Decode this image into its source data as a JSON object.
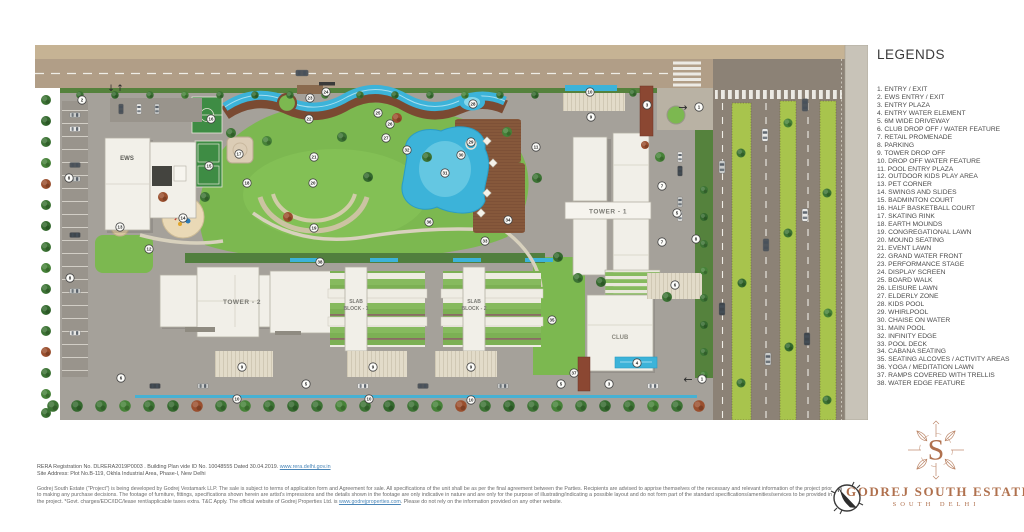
{
  "legend": {
    "title": "LEGENDS",
    "items": [
      "ENTRY / EXIT",
      "EWS ENTRY / EXIT",
      "ENTRY PLAZA",
      "ENTRY WATER ELEMENT",
      "6M WIDE DRIVEWAY",
      "CLUB DROP OFF / WATER FEATURE",
      "RETAIL PROMENADE",
      "PARKING",
      "TOWER DROP OFF",
      "DROP OFF WATER FEATURE",
      "POOL ENTRY PLAZA",
      "OUTDOOR KIDS PLAY AREA",
      "PET CORNER",
      "SWINGS AND SLIDES",
      "BADMINTON COURT",
      "HALF BASKETBALL COURT",
      "SKATING RINK",
      "EARTH MOUNDS",
      "CONGREGATIONAL LAWN",
      "MOUND SEATING",
      "EVENT LAWN",
      "GRAND WATER FRONT",
      "PERFORMANCE STAGE",
      "DISPLAY SCREEN",
      "BOARD WALK",
      "LEISURE LAWN",
      "ELDERLY ZONE",
      "KIDS POOL",
      "WHIRLPOOL",
      "CHAISE ON WATER",
      "MAIN POOL",
      "INFINITY EDGE",
      "POOL DECK",
      "CABANA SEATING",
      "SEATING ALCOVES / ACTIVITY AREAS",
      "YOGA / MEDITATION LAWN",
      "RAMPS COVERED WITH TRELLIS",
      "WATER EDGE FEATURE"
    ]
  },
  "plan": {
    "labels": {
      "ews": "EWS",
      "tower1": "TOWER - 1",
      "tower2": "TOWER - 2",
      "slab1_line1": "SLAB",
      "slab1_line2": "BLOCK - 1",
      "slab2_line1": "SLAB",
      "slab2_line2": "BLOCK - 2",
      "club": "CLUB"
    },
    "arrows": {
      "right": "→",
      "left": "←",
      "down": "↓",
      "up": "↑"
    },
    "markers": [
      {
        "n": 1,
        "x": 664,
        "y": 62
      },
      {
        "n": 1,
        "x": 667,
        "y": 334
      },
      {
        "n": 2,
        "x": 47,
        "y": 55
      },
      {
        "n": 3,
        "x": 612,
        "y": 60
      },
      {
        "n": 3,
        "x": 574,
        "y": 339
      },
      {
        "n": 4,
        "x": 602,
        "y": 318
      },
      {
        "n": 5,
        "x": 642,
        "y": 168
      },
      {
        "n": 5,
        "x": 271,
        "y": 339
      },
      {
        "n": 5,
        "x": 526,
        "y": 339
      },
      {
        "n": 6,
        "x": 86,
        "y": 333
      },
      {
        "n": 6,
        "x": 640,
        "y": 240
      },
      {
        "n": 7,
        "x": 627,
        "y": 141
      },
      {
        "n": 7,
        "x": 627,
        "y": 197
      },
      {
        "n": 8,
        "x": 34,
        "y": 133
      },
      {
        "n": 8,
        "x": 35,
        "y": 233
      },
      {
        "n": 8,
        "x": 661,
        "y": 194
      },
      {
        "n": 9,
        "x": 556,
        "y": 72
      },
      {
        "n": 9,
        "x": 207,
        "y": 322
      },
      {
        "n": 9,
        "x": 338,
        "y": 322
      },
      {
        "n": 9,
        "x": 436,
        "y": 322
      },
      {
        "n": 10,
        "x": 555,
        "y": 47
      },
      {
        "n": 10,
        "x": 202,
        "y": 354
      },
      {
        "n": 10,
        "x": 334,
        "y": 354
      },
      {
        "n": 10,
        "x": 436,
        "y": 355
      },
      {
        "n": 11,
        "x": 501,
        "y": 102
      },
      {
        "n": 12,
        "x": 114,
        "y": 204
      },
      {
        "n": 13,
        "x": 85,
        "y": 182
      },
      {
        "n": 14,
        "x": 148,
        "y": 173
      },
      {
        "n": 15,
        "x": 174,
        "y": 121
      },
      {
        "n": 16,
        "x": 176,
        "y": 74
      },
      {
        "n": 17,
        "x": 204,
        "y": 109
      },
      {
        "n": 18,
        "x": 212,
        "y": 138
      },
      {
        "n": 19,
        "x": 279,
        "y": 183
      },
      {
        "n": 20,
        "x": 278,
        "y": 138
      },
      {
        "n": 21,
        "x": 279,
        "y": 112
      },
      {
        "n": 22,
        "x": 274,
        "y": 74
      },
      {
        "n": 23,
        "x": 275,
        "y": 53
      },
      {
        "n": 24,
        "x": 291,
        "y": 47
      },
      {
        "n": 25,
        "x": 343,
        "y": 68
      },
      {
        "n": 26,
        "x": 355,
        "y": 79
      },
      {
        "n": 27,
        "x": 351,
        "y": 93
      },
      {
        "n": 28,
        "x": 438,
        "y": 59
      },
      {
        "n": 29,
        "x": 436,
        "y": 97
      },
      {
        "n": 30,
        "x": 426,
        "y": 110
      },
      {
        "n": 31,
        "x": 410,
        "y": 128
      },
      {
        "n": 32,
        "x": 372,
        "y": 105
      },
      {
        "n": 33,
        "x": 450,
        "y": 196
      },
      {
        "n": 34,
        "x": 473,
        "y": 175
      },
      {
        "n": 35,
        "x": 517,
        "y": 275
      },
      {
        "n": 36,
        "x": 394,
        "y": 177
      },
      {
        "n": 37,
        "x": 539,
        "y": 328
      },
      {
        "n": 38,
        "x": 285,
        "y": 217
      }
    ]
  },
  "footer": {
    "rera_text": "RERA Registration No. DLRERA2019P0003 . Building Plan vide ID No. 10048555 Dated 30.04.2019. ",
    "rera_link": "www.rera.delhi.gov.in",
    "site_address": "Site Address: Plot No.B-119, Okhla Industrial Area, Phase-I, New Delhi",
    "disclaimer_part1": "Godrej South Estate (\"Project\") is being developed by Godrej Vestamark LLP. The sale is subject to terms of application form and Agreement for sale. All specifications of the unit shall be as per the final agreement between the Parties. Recipients are advised to apprise themselves of the necessary and relevant information of the project prior to making any purchase decisions. The footage of furniture, fittings, specifications shown herein are artist's impressions and the details shown in the footage are only indicative in nature and are only for the purpose of illustrating/indicating a possible layout and do not form part of the standard specifications/amenities/services to be provided in the project. *Govt. charges/EDC/IDC/lease rent/applicable taxes extra. T&C Apply. The official website of Godrej Properties Ltd. is ",
    "disclaimer_link": "www.godrejproperties.com",
    "disclaimer_part2": ". Please do not rely on the information provided on any other website."
  },
  "brand": {
    "monogram": "S",
    "name": "GODREJ SOUTH ESTATE",
    "location": "SOUTH DELHI",
    "compass_label": "N",
    "accent_color": "#b0714e"
  }
}
